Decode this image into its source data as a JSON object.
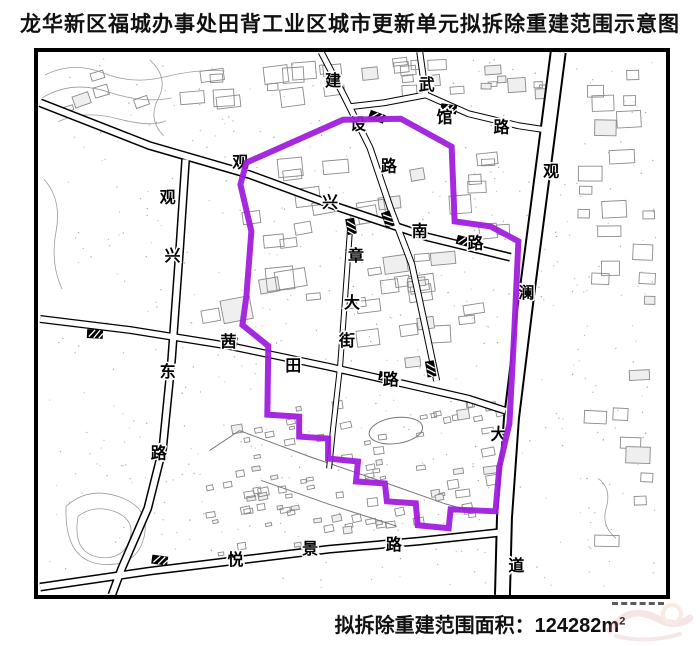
{
  "title": "龙华新区福城办事处田背工业区城市更新单元拟拆除重建范围示意图",
  "caption": {
    "label": "拟拆除重建范围面积：",
    "value": "124282",
    "unit_base": "m",
    "unit_exp": "2"
  },
  "map": {
    "border_color": "#000000",
    "boundary": {
      "name": "拟拆除重建范围",
      "color": "#A01EDC",
      "width": 6,
      "points": [
        [
          247,
          163
        ],
        [
          344,
          120
        ],
        [
          402,
          119
        ],
        [
          453,
          147
        ],
        [
          456,
          222
        ],
        [
          492,
          227
        ],
        [
          520,
          242
        ],
        [
          516,
          330
        ],
        [
          511,
          425
        ],
        [
          501,
          468
        ],
        [
          497,
          513
        ],
        [
          452,
          511
        ],
        [
          450,
          530
        ],
        [
          419,
          527
        ],
        [
          417,
          505
        ],
        [
          388,
          503
        ],
        [
          386,
          485
        ],
        [
          357,
          483
        ],
        [
          359,
          463
        ],
        [
          329,
          460
        ],
        [
          329,
          440
        ],
        [
          300,
          438
        ],
        [
          300,
          418
        ],
        [
          268,
          416
        ],
        [
          269,
          347
        ],
        [
          243,
          326
        ],
        [
          247,
          297
        ],
        [
          252,
          232
        ],
        [
          241,
          185
        ]
      ]
    },
    "roads": [
      {
        "id": "guanlan-dadao",
        "name": "观澜大道",
        "width": 17,
        "inner": 13,
        "points": [
          [
            560,
            52
          ],
          [
            546,
            160
          ],
          [
            529,
            290
          ],
          [
            513,
            420
          ],
          [
            506,
            520
          ],
          [
            504,
            597
          ]
        ],
        "label_chars": [
          {
            "t": "观",
            "x": 553,
            "y": 177
          },
          {
            "t": "澜",
            "x": 528,
            "y": 299
          },
          {
            "t": "大",
            "x": 500,
            "y": 441
          },
          {
            "t": "道",
            "x": 518,
            "y": 573
          }
        ]
      },
      {
        "id": "guanxing-nan-lu",
        "name": "观兴南路",
        "width": 9,
        "inner": 6,
        "points": [
          [
            40,
            103
          ],
          [
            150,
            146
          ],
          [
            250,
            175
          ],
          [
            340,
            208
          ],
          [
            430,
            238
          ],
          [
            512,
            258
          ]
        ],
        "label_chars": [
          {
            "t": "观",
            "x": 241,
            "y": 168
          },
          {
            "t": "兴",
            "x": 331,
            "y": 208
          },
          {
            "t": "南",
            "x": 421,
            "y": 237
          },
          {
            "t": "路",
            "x": 477,
            "y": 249
          }
        ]
      },
      {
        "id": "guanxing-dong-lu",
        "name": "观兴东路",
        "width": 9,
        "inner": 6,
        "points": [
          [
            186,
            160
          ],
          [
            180,
            250
          ],
          [
            172,
            360
          ],
          [
            163,
            450
          ],
          [
            148,
            510
          ],
          [
            122,
            570
          ],
          [
            112,
            597
          ]
        ],
        "label_chars": [
          {
            "t": "观",
            "x": 168,
            "y": 203
          },
          {
            "t": "兴",
            "x": 173,
            "y": 262
          },
          {
            "t": "东",
            "x": 168,
            "y": 378
          },
          {
            "t": "路",
            "x": 159,
            "y": 460
          }
        ]
      },
      {
        "id": "yuejing-lu",
        "name": "悦景路",
        "width": 9,
        "inner": 6,
        "points": [
          [
            40,
            589
          ],
          [
            150,
            573
          ],
          [
            240,
            562
          ],
          [
            330,
            551
          ],
          [
            420,
            543
          ],
          [
            504,
            534
          ]
        ],
        "label_chars": [
          {
            "t": "悦",
            "x": 236,
            "y": 567
          },
          {
            "t": "景",
            "x": 311,
            "y": 556
          },
          {
            "t": "路",
            "x": 395,
            "y": 552
          }
        ]
      },
      {
        "id": "qiantian-lu",
        "name": "茜田路",
        "width": 8,
        "inner": 5.5,
        "points": [
          [
            40,
            320
          ],
          [
            130,
            331
          ],
          [
            230,
            347
          ],
          [
            330,
            368
          ],
          [
            418,
            388
          ],
          [
            470,
            400
          ],
          [
            507,
            412
          ]
        ],
        "label_chars": [
          {
            "t": "茜",
            "x": 229,
            "y": 348
          },
          {
            "t": "田",
            "x": 294,
            "y": 372
          },
          {
            "t": "路",
            "x": 392,
            "y": 386
          }
        ]
      },
      {
        "id": "jianshe-lu",
        "name": "建设路",
        "width": 7,
        "inner": 5,
        "points": [
          [
            322,
            52
          ],
          [
            344,
            94
          ],
          [
            371,
            148
          ],
          [
            392,
            210
          ],
          [
            413,
            265
          ],
          [
            427,
            330
          ],
          [
            438,
            382
          ]
        ],
        "label_chars": [
          {
            "t": "建",
            "x": 334,
            "y": 86
          },
          {
            "t": "设",
            "x": 359,
            "y": 130
          },
          {
            "t": "路",
            "x": 390,
            "y": 172
          }
        ]
      },
      {
        "id": "wuguan-lu",
        "name": "武馆路",
        "width": 7,
        "inner": 5,
        "points": [
          [
            421,
            52
          ],
          [
            427,
            95
          ],
          [
            470,
            114
          ],
          [
            520,
            126
          ],
          [
            553,
            131
          ]
        ],
        "label_chars": [
          {
            "t": "武",
            "x": 428,
            "y": 90
          },
          {
            "t": "馆",
            "x": 446,
            "y": 123
          },
          {
            "t": "路",
            "x": 503,
            "y": 133
          }
        ]
      },
      {
        "id": "wuguan-lu-west",
        "name": "武馆路西段",
        "width": 7,
        "inner": 5,
        "points": [
          [
            427,
            95
          ],
          [
            385,
            103
          ],
          [
            350,
            107
          ]
        ],
        "label_chars": []
      },
      {
        "id": "zhang-dajie",
        "name": "章大街",
        "width": 6,
        "inner": 4,
        "points": [
          [
            351,
            230
          ],
          [
            346,
            300
          ],
          [
            341,
            368
          ],
          [
            334,
            430
          ],
          [
            330,
            470
          ]
        ],
        "label_chars": [
          {
            "t": "章",
            "x": 357,
            "y": 262
          },
          {
            "t": "大",
            "x": 353,
            "y": 309
          },
          {
            "t": "街",
            "x": 348,
            "y": 347
          }
        ]
      }
    ],
    "crossings": [
      {
        "x": 378,
        "y": 117,
        "a": 20
      },
      {
        "x": 450,
        "y": 109,
        "a": 8
      },
      {
        "x": 352,
        "y": 227,
        "a": 80
      },
      {
        "x": 389,
        "y": 220,
        "a": 70
      },
      {
        "x": 466,
        "y": 242,
        "a": 15
      },
      {
        "x": 230,
        "y": 342,
        "a": 8
      },
      {
        "x": 388,
        "y": 378,
        "a": 10
      },
      {
        "x": 95,
        "y": 335,
        "a": 3
      },
      {
        "x": 432,
        "y": 370,
        "a": 80
      },
      {
        "x": 160,
        "y": 562,
        "a": 8
      }
    ]
  }
}
